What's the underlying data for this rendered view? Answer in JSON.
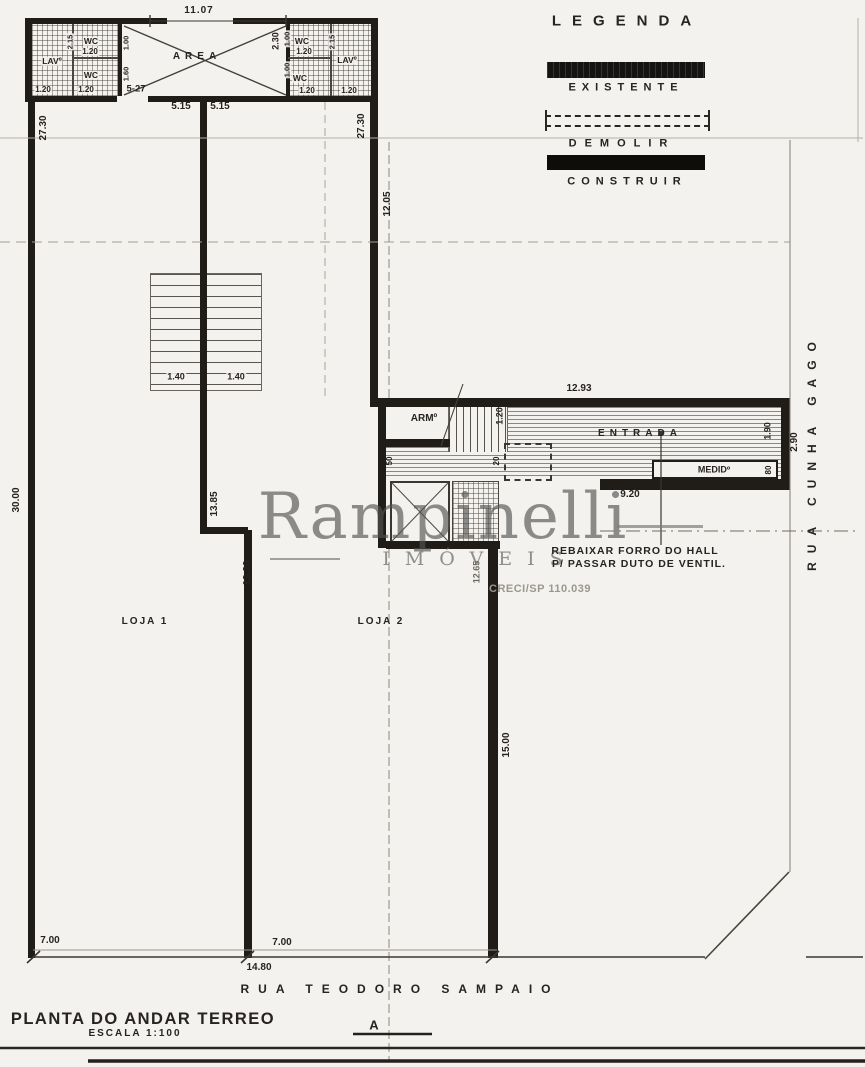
{
  "legend": {
    "title": "LEGENDA",
    "items": [
      {
        "label": "EXISTENTE"
      },
      {
        "label": "DEMOLIR"
      },
      {
        "label": "CONSTRUIR"
      }
    ]
  },
  "titleblock": {
    "title": "PLANTA DO ANDAR TERREO",
    "scale": "ESCALA  1:100",
    "section": "A"
  },
  "streets": {
    "bottom": "RUA TEODORO SAMPAIO",
    "right": "RUA CUNHA GAGO"
  },
  "rooms": {
    "area": "AREA",
    "loja1": "LOJA 1",
    "loja2": "LOJA 2",
    "entrada": "ENTRADA",
    "arm": "ARMº",
    "medidor": "MEDIDº",
    "lav_left": "LAVº",
    "lav_right": "LAVº",
    "wc": "WC"
  },
  "note": {
    "line1": "REBAIXAR FORRO DO HALL",
    "line2": "P/ PASSAR DUTO DE VENTIL."
  },
  "watermark": {
    "name": "Rampinelli",
    "subtitle": "IMÓVEIS",
    "creci": "CRECI/SP 110.039"
  },
  "dims": {
    "w_total": "11.07",
    "d_left": "27.30",
    "d_mid": "27.30",
    "d_inner": "12.05",
    "d_left_total": "30.00",
    "area_side": "5-27",
    "half_a": "5.15",
    "half_b": "5.15",
    "stair_w1": "1.40",
    "stair_w2": "1.40",
    "run_13_85": "13.85",
    "wall_13_20": "13.20",
    "hall_w": "12.93",
    "hall_d": "1.90",
    "setback": "2.90",
    "entry_w": "9.20",
    "wall_15": "15.00",
    "wall_12_65": "12.65",
    "front_a": "7.00",
    "front_b": "7.00",
    "front_total": "14.80",
    "h_2_30": "2.30",
    "stair_hall": "1.20",
    "s50": "50",
    "s20": "20",
    "s80": "80",
    "lb_wc_top_w": "1.20",
    "lb_v1": "2.15",
    "lb_v2": "1.00",
    "lb_v3": "1.60",
    "lb_b1": "1.20",
    "lb_b2": "1.20",
    "rb_wc_top_w": "1.20",
    "rb_v1": "1.00",
    "rb_v2": "2.15",
    "rb_v3": "1.00",
    "rb_b1": "1.20",
    "rb_b2": "1.20"
  }
}
